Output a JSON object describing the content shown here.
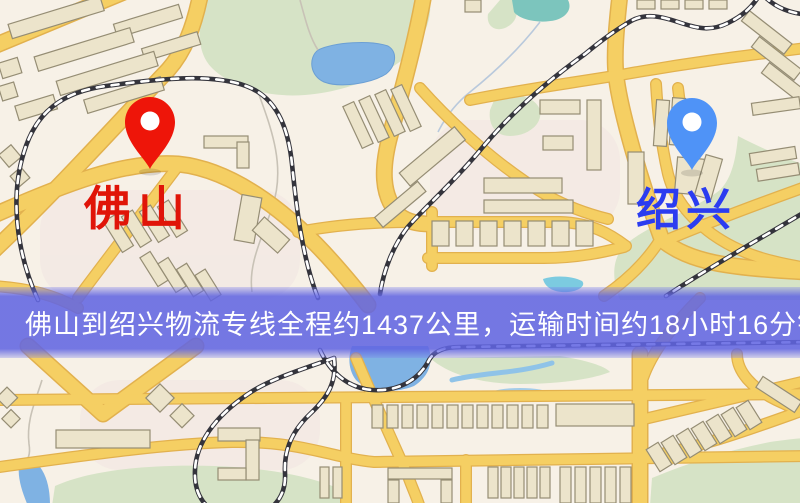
{
  "map": {
    "markers": [
      {
        "name": "佛山",
        "pin_color": "#ee1509",
        "label_color": "#e01408"
      },
      {
        "name": "绍兴",
        "pin_color": "#4f93f7",
        "label_color": "#2b3cf0"
      }
    ],
    "banner": {
      "text": "佛山到绍兴物流专线全程约1437公里，运输时间约18小时16分钟.",
      "background_color": "#6165e2",
      "text_color": "#ffffff",
      "route": {
        "from": "佛山",
        "to": "绍兴",
        "distance_text": "约1437公里",
        "duration_text": "约18小时16分钟"
      }
    },
    "palette": {
      "background": "#f7f1e7",
      "road": "#f5cf63",
      "road_edge": "#e2b14e",
      "park": "#d6e3c6",
      "water": "#7fb2e3",
      "building": "#ece4cb",
      "railway": "#34343c"
    }
  }
}
